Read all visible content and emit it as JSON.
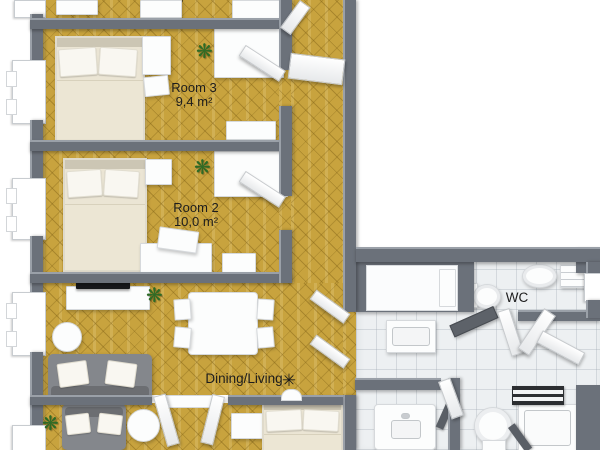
{
  "colors": {
    "wall": "#6b717a",
    "wall_light": "#9aa0a8",
    "parquet": "#c8a33e",
    "tile": "#edf0f2",
    "label": "#1d1d1d",
    "plant": "#2e6b25",
    "sofa": "#84878c",
    "tv": "#17181b"
  },
  "rooms": {
    "top_room": {
      "area_partial": "12,0 m²"
    },
    "room3": {
      "name": "Room 3",
      "area": "9,4 m²"
    },
    "room2": {
      "name": "Room 2",
      "area": "10,0 m²"
    },
    "dining_living": {
      "name": "Dining/Living"
    },
    "wc": {
      "name": "WC"
    }
  },
  "icons": {
    "plant_glyph": "❋",
    "light_glyph": "✳"
  }
}
